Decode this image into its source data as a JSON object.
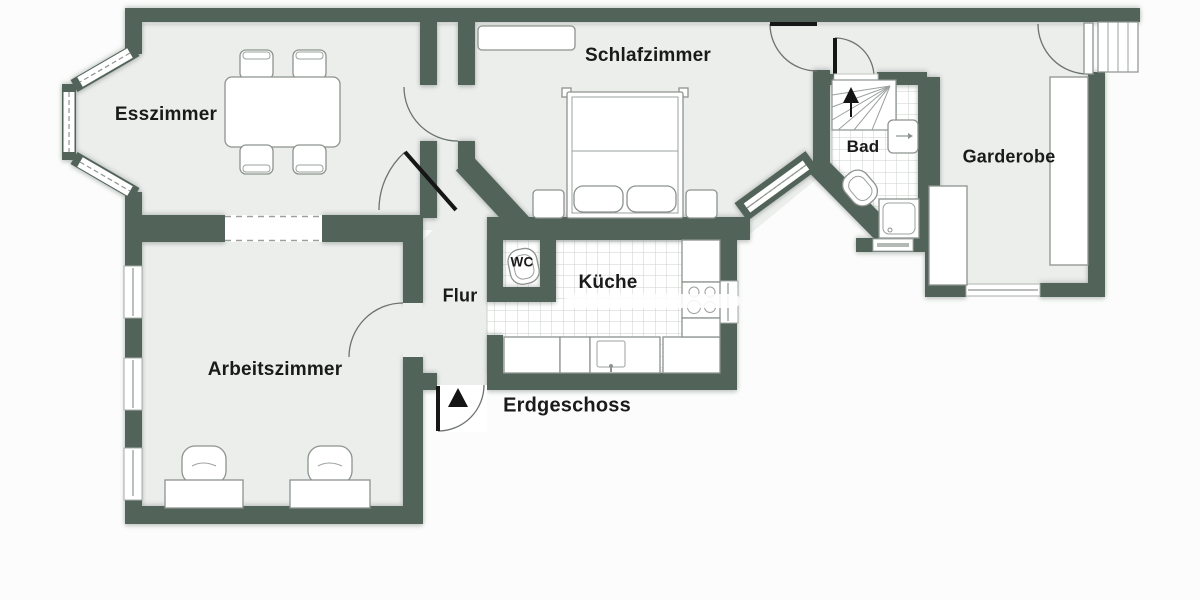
{
  "plan": {
    "title": "Erdgeschoss",
    "rooms": {
      "esszimmer": {
        "label": "Esszimmer"
      },
      "schlafzimmer": {
        "label": "Schlafzimmer"
      },
      "bad": {
        "label": "Bad"
      },
      "garderobe": {
        "label": "Garderobe"
      },
      "arbeitszimmer": {
        "label": "Arbeitszimmer"
      },
      "flur": {
        "label": "Flur"
      },
      "wc": {
        "label": "WC"
      },
      "kueche": {
        "label": "Küche"
      }
    },
    "icons": {
      "entrance_marker": "black-triangle-up",
      "stairs_up_marker": "black-triangle-up"
    },
    "colors": {
      "wall": "#52635a",
      "floor": "#eceeec",
      "tile_line": "#ccd2ce",
      "label": "#1a1a1a",
      "background": "#fbfcfb"
    }
  }
}
